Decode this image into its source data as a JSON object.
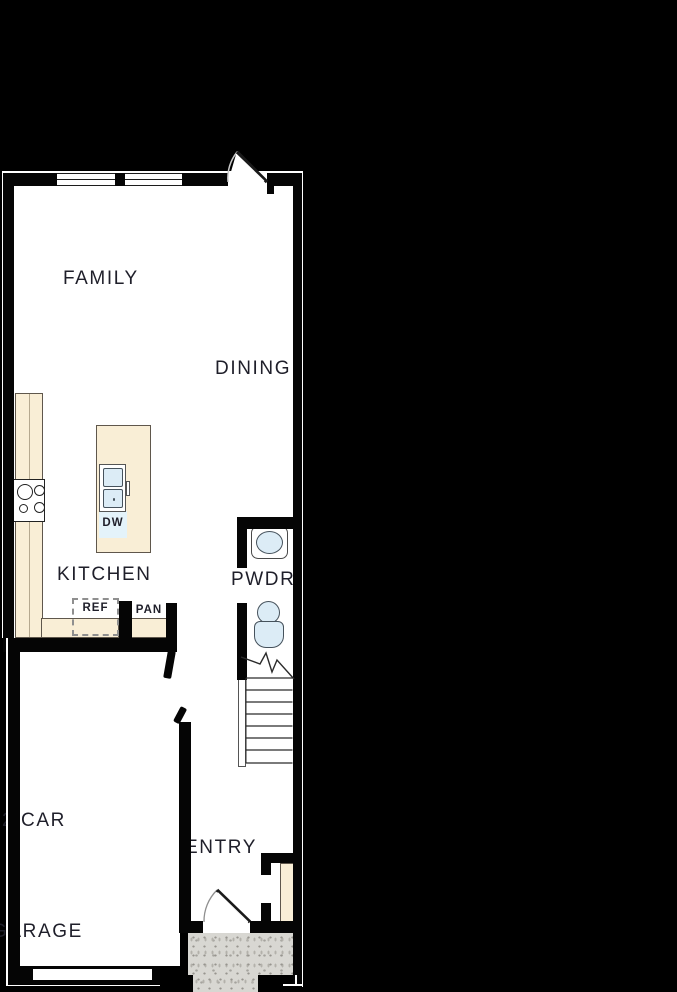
{
  "plan": {
    "rooms": {
      "family": "FAMILY",
      "dining": "DINING",
      "kitchen": "KITCHEN",
      "powder": "PWDR",
      "entry": "ENTRY",
      "garage_line1": "2 CAR",
      "garage_line2": "GARAGE"
    },
    "fixtures": {
      "dishwasher": "DW",
      "refrigerator": "REF",
      "pantry": "PAN"
    },
    "colors": {
      "background": "#000000",
      "wall": "#050505",
      "floor": "#ffffff",
      "counter": "#f9eed6",
      "counter-edge": "#5f574c",
      "fixture-fill": "#dcecf6",
      "fixture-edge": "#46525c",
      "dw-patch": "#e4f3fa",
      "porch": "#d8d7d2",
      "porch-dot": "#97958f",
      "text": "#1f1f2a",
      "hairline": "#ffffff"
    }
  }
}
